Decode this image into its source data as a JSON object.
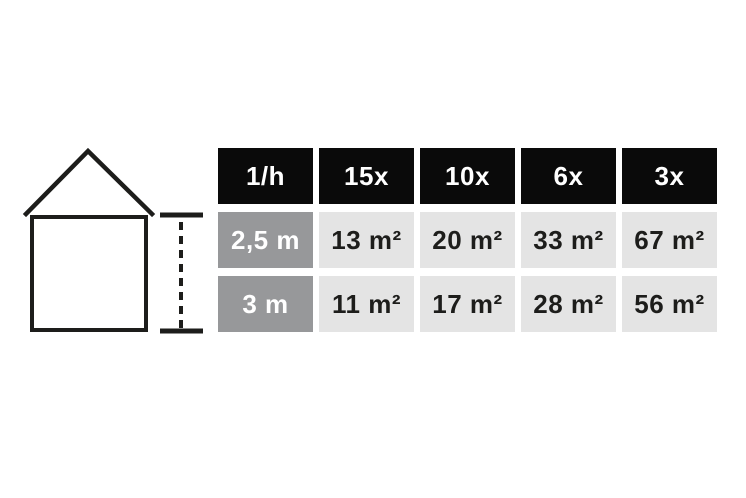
{
  "colors": {
    "background": "#ffffff",
    "header_bg": "#0a0a0a",
    "header_text": "#ffffff",
    "row_label_bg": "#97989a",
    "row_label_text": "#ffffff",
    "value_cell_bg": "#e4e4e4",
    "value_cell_text": "#1d1d1b",
    "line_color": "#1d1d1b"
  },
  "figure": {
    "icons": [
      "house-icon",
      "room-height-measure-icon"
    ]
  },
  "chart_data": {
    "type": "table",
    "title": "",
    "columns": [
      "1/h",
      "15x",
      "10x",
      "6x",
      "3x"
    ],
    "rows": [
      {
        "label": "2,5 m",
        "values": [
          "13 m²",
          "20 m²",
          "33 m²",
          "67 m²"
        ]
      },
      {
        "label": "3 m",
        "values": [
          "11 m²",
          "17 m²",
          "28 m²",
          "56 m²"
        ]
      }
    ]
  },
  "table": {
    "header": [
      "1/h",
      "15x",
      "10x",
      "6x",
      "3x"
    ],
    "rows": [
      {
        "label": "2,5 m",
        "values": [
          "13 m²",
          "20 m²",
          "33 m²",
          "67 m²"
        ]
      },
      {
        "label": "3 m",
        "values": [
          "11 m²",
          "17 m²",
          "28 m²",
          "56 m²"
        ]
      }
    ]
  }
}
